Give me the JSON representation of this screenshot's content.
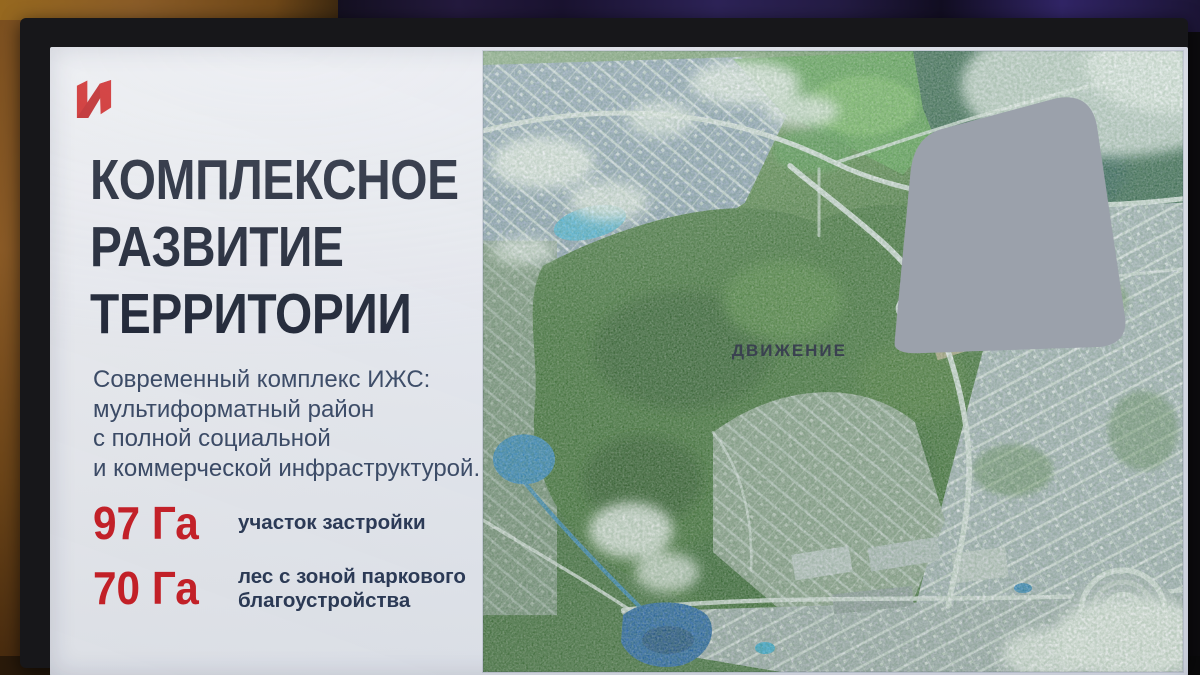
{
  "brand": {
    "letter": "И",
    "color": "#d42523",
    "icon": "red-flag-i-logo"
  },
  "title": {
    "line1": "КОМПЛЕКСНОЕ",
    "line2": "РАЗВИТИЕ",
    "line3": "ТЕРРИТОРИИ",
    "color": "#1d2433"
  },
  "subtitle": {
    "line1": "Современный комплекс ИЖС:",
    "line2": "мультиформатный район",
    "line3": "с полной социальной",
    "line4": "и коммерческой инфраструктурой."
  },
  "stats": {
    "value_color": "#cd2026",
    "label_color": "#2b3a55",
    "items": [
      {
        "value": "97 Га",
        "label": "участок застройки"
      },
      {
        "value": "70 Га",
        "label": "лес с зоной паркового благоустройства"
      }
    ]
  },
  "watermark": {
    "label": "ДВИЖЕНИЕ",
    "icon": "house-icon",
    "icon_color": "#9ba1ab"
  },
  "map": {
    "kind": "aerial-satellite-render",
    "features": [
      "forest",
      "residential-grids",
      "lakes",
      "clouds",
      "roads",
      "sports-field",
      "fan-shaped-quarter"
    ]
  },
  "scene": {
    "device": "tv-screen-photo",
    "bezel_color": "#17171a",
    "wall_colors": [
      "#8a5c28",
      "#2d2357"
    ]
  }
}
